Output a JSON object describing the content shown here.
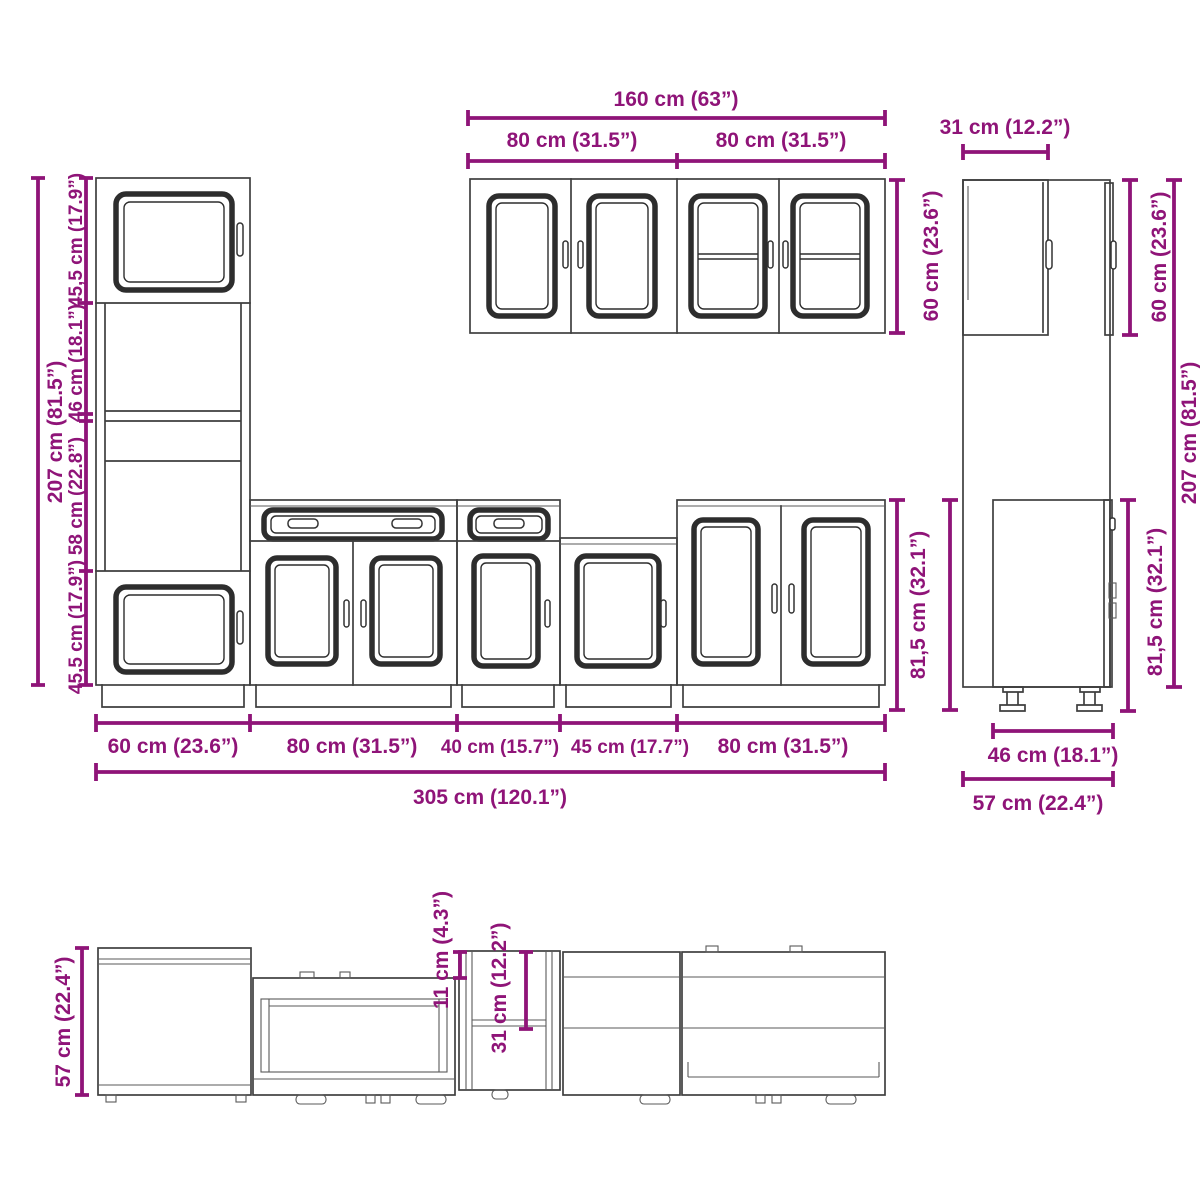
{
  "diagram_title": "kitchen-cabinet-set-dimension-diagram",
  "colors": {
    "dimension_accent": "#8F1478",
    "outline": "#3f3f3f",
    "background": "#ffffff"
  },
  "labels": {
    "wall_cabinets_front": {
      "total_width": "160 cm (63”)",
      "left_width": "80 cm (31.5”)",
      "right_width": "80 cm (31.5”)",
      "height": "60 cm (23.6”)"
    },
    "tall_cabinet_front": {
      "total_height": "207 cm (81.5”)",
      "segment_top": "45,5 cm (17.9”)",
      "segment_oven": "46 cm (18.1”)",
      "segment_middle": "58 cm (22.8”)",
      "segment_bottom": "45,5 cm (17.9”)"
    },
    "base_cabinets_front": {
      "height": "81,5 cm (32.1”)",
      "width_1": "60 cm (23.6”)",
      "width_2": "80 cm (31.5”)",
      "width_3": "40 cm (15.7”)",
      "width_4": "45 cm (17.7”)",
      "width_5": "80 cm (31.5”)",
      "total_width": "305 cm (120.1”)"
    },
    "side_view": {
      "top_depth": "31 cm (12.2”)",
      "wall_cabinet_height": "60 cm (23.6”)",
      "total_height": "207 cm (81.5”)",
      "base_height": "81,5 cm (32.1”)",
      "base_depth": "46 cm (18.1”)",
      "total_depth": "57 cm (22.4”)"
    },
    "top_view": {
      "depth": "57 cm (22.4”)",
      "front_offset": "11 cm (4.3”)",
      "wall_depth": "31 cm (12.2”)"
    }
  }
}
